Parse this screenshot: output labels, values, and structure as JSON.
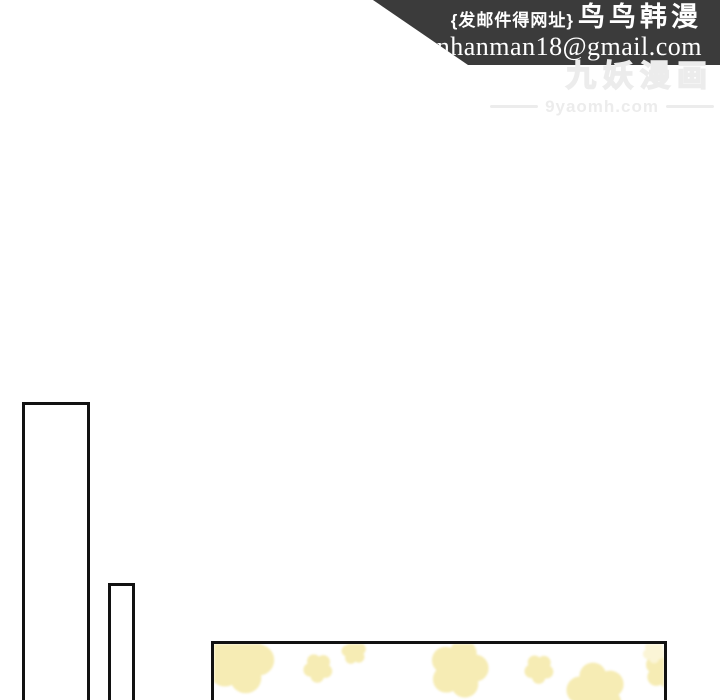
{
  "page": {
    "background": "#ffffff"
  },
  "banner": {
    "background": "#3b3b3b",
    "text_color": "#ffffff",
    "line1_prefix": "{发邮件得网址}",
    "line1_title": "鸟鸟韩漫",
    "line2_email": "nnhanman18@gmail.com"
  },
  "watermark": {
    "title": "九妖漫画",
    "site": "9yaomh.com",
    "color": "#ececec"
  },
  "artwork": {
    "outline_color": "#121212",
    "pattern_color": "#f6ecb4",
    "pattern_color_light": "#fbf5d6",
    "flowers": [
      {
        "cx": 26,
        "cy": 16,
        "r": 30,
        "light": false
      },
      {
        "cx": 104,
        "cy": 24,
        "r": 13,
        "light": false
      },
      {
        "cx": 140,
        "cy": 8,
        "r": 11,
        "light": false
      },
      {
        "cx": 245,
        "cy": 25,
        "r": 26,
        "light": false
      },
      {
        "cx": 325,
        "cy": 25,
        "r": 13,
        "light": false
      },
      {
        "cx": 382,
        "cy": 48,
        "r": 26,
        "light": false
      },
      {
        "cx": 450,
        "cy": 26,
        "r": 17,
        "light": false
      },
      {
        "cx": 440,
        "cy": 8,
        "r": 10,
        "light": true
      }
    ]
  }
}
